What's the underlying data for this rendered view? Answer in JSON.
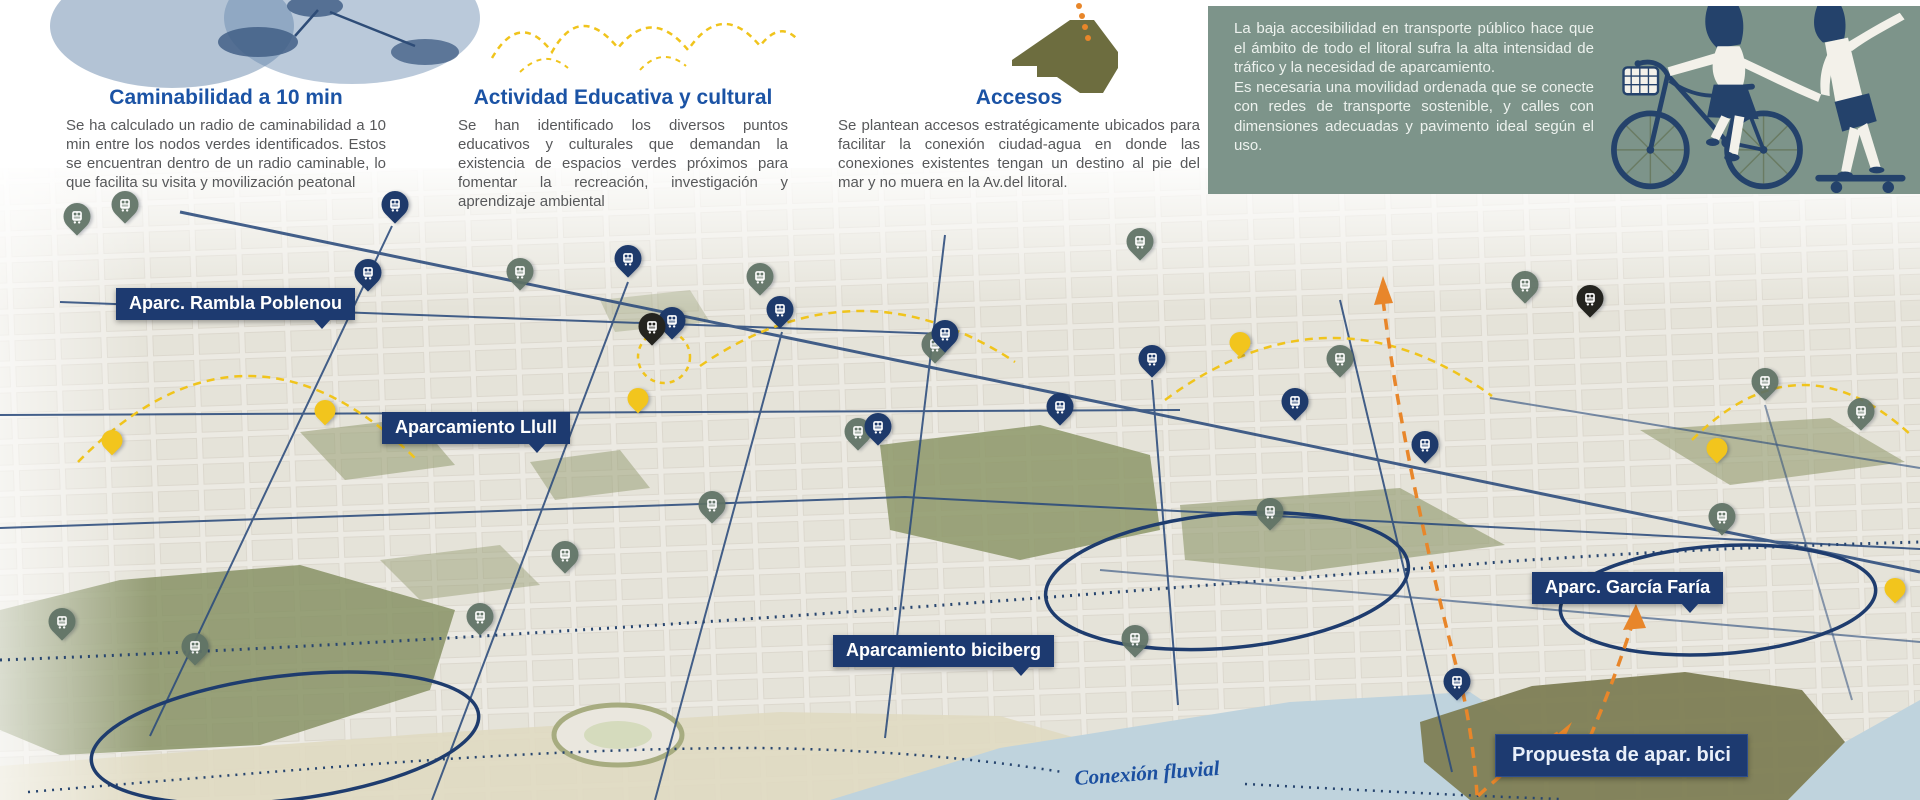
{
  "poster": {
    "sections": {
      "walkability": {
        "title": "Caminabilidad a 10 min",
        "body": "Se ha calculado un radio de caminabilidad a 10 min entre los nodos verdes identificados. Estos se encuentran dentro de un radio caminable, lo que facilita su visita y movilización peatonal"
      },
      "education": {
        "title": "Actividad Educativa y cultural",
        "body": "Se han identificado los diversos puntos educativos y culturales que demandan la existencia de espacios verdes próximos para fomentar la recreación, investigación y aprendizaje ambiental"
      },
      "access": {
        "title": "Accesos",
        "body": "Se plantean accesos estratégicamente ubicados para facilitar la conexión ciudad-agua en donde las conexiones existentes tengan un destino al pie del mar y no muera en la Av.del litoral."
      },
      "mobility": {
        "p1": "La baja accesibilidad en transporte público hace que el ámbito de todo el litoral sufra la alta intensidad de tráfico y la necesidad de aparcamiento.",
        "p2": "Es necesaria una movilidad ordenada que se conecte con redes de transporte sostenible, y calles con dimensiones adecuadas y pavimento ideal según el uso."
      }
    },
    "map": {
      "flow_label": "Conexión fluvial",
      "labels": [
        {
          "id": "rambla",
          "text": "Aparc. Rambla Poblenou",
          "x": 116,
          "y": 288,
          "tail": true
        },
        {
          "id": "llull",
          "text": "Aparcamiento Llull",
          "x": 382,
          "y": 412,
          "tail": true
        },
        {
          "id": "garcia",
          "text": "Aparc. García Faría",
          "x": 1532,
          "y": 572,
          "tail": true
        },
        {
          "id": "biciberg",
          "text": "Aparcamiento biciberg",
          "x": 833,
          "y": 635,
          "tail": true
        },
        {
          "id": "propuesta",
          "text": "Propuesta de apar. bici",
          "x": 1495,
          "y": 734,
          "tail": false
        }
      ],
      "pins": [
        {
          "x": 77,
          "y": 240,
          "t": "sage"
        },
        {
          "x": 125,
          "y": 228,
          "t": "sage"
        },
        {
          "x": 520,
          "y": 295,
          "t": "sage"
        },
        {
          "x": 760,
          "y": 300,
          "t": "sage"
        },
        {
          "x": 935,
          "y": 368,
          "t": "sage"
        },
        {
          "x": 1140,
          "y": 265,
          "t": "sage"
        },
        {
          "x": 1340,
          "y": 382,
          "t": "sage"
        },
        {
          "x": 1525,
          "y": 308,
          "t": "sage"
        },
        {
          "x": 1765,
          "y": 405,
          "t": "sage"
        },
        {
          "x": 1861,
          "y": 435,
          "t": "sage"
        },
        {
          "x": 480,
          "y": 640,
          "t": "sage"
        },
        {
          "x": 195,
          "y": 670,
          "t": "sage"
        },
        {
          "x": 62,
          "y": 645,
          "t": "sage"
        },
        {
          "x": 565,
          "y": 578,
          "t": "sage"
        },
        {
          "x": 712,
          "y": 528,
          "t": "sage"
        },
        {
          "x": 858,
          "y": 455,
          "t": "sage"
        },
        {
          "x": 1135,
          "y": 662,
          "t": "sage"
        },
        {
          "x": 1270,
          "y": 535,
          "t": "sage"
        },
        {
          "x": 1722,
          "y": 540,
          "t": "sage"
        },
        {
          "x": 395,
          "y": 228,
          "t": "navy"
        },
        {
          "x": 368,
          "y": 296,
          "t": "navy"
        },
        {
          "x": 628,
          "y": 282,
          "t": "navy"
        },
        {
          "x": 672,
          "y": 344,
          "t": "navy"
        },
        {
          "x": 780,
          "y": 333,
          "t": "navy"
        },
        {
          "x": 945,
          "y": 357,
          "t": "navy"
        },
        {
          "x": 1152,
          "y": 382,
          "t": "navy"
        },
        {
          "x": 1295,
          "y": 425,
          "t": "navy"
        },
        {
          "x": 1425,
          "y": 468,
          "t": "navy"
        },
        {
          "x": 878,
          "y": 450,
          "t": "navy"
        },
        {
          "x": 1060,
          "y": 430,
          "t": "navy"
        },
        {
          "x": 1457,
          "y": 705,
          "t": "navy"
        },
        {
          "x": 112,
          "y": 460,
          "t": "yellow"
        },
        {
          "x": 325,
          "y": 430,
          "t": "yellow"
        },
        {
          "x": 638,
          "y": 418,
          "t": "yellow"
        },
        {
          "x": 1240,
          "y": 362,
          "t": "yellow"
        },
        {
          "x": 1717,
          "y": 468,
          "t": "yellow"
        },
        {
          "x": 1895,
          "y": 608,
          "t": "yellow"
        },
        {
          "x": 652,
          "y": 350,
          "t": "black"
        },
        {
          "x": 1590,
          "y": 322,
          "t": "black"
        }
      ]
    },
    "icons": {
      "pin_glyph": "bus-icon"
    },
    "colors": {
      "navy": "#1e3a6b",
      "sage": "#5f7265",
      "yellow": "#f2c51d",
      "black": "#24241f",
      "orange": "#e8862a",
      "label_bg": "#1d3a70",
      "heading_blue": "#1b53a5",
      "body_gray": "#57585a",
      "green_box": "#7d948a",
      "olive": "#6d6d3f",
      "water": "#b6cdd8",
      "sand": "#dcd5b9"
    }
  }
}
